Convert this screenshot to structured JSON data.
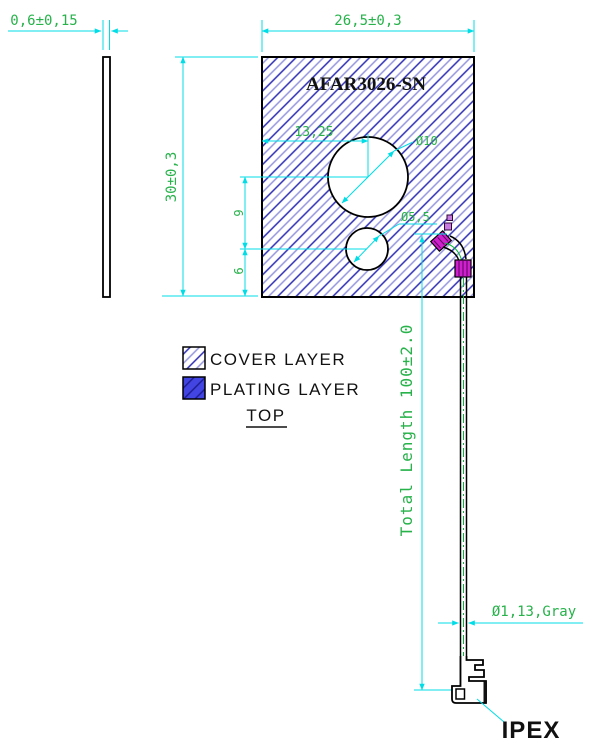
{
  "drawing": {
    "part_number": "AFAR3026-SN",
    "view_label": "TOP",
    "connector_label": "IPEX"
  },
  "dimensions": {
    "thickness": "0,6±0,15",
    "board_width": "26,5±0,3",
    "board_height": "30±0,3",
    "hole_offset_x": "13,25",
    "large_hole_diameter": "Ø10",
    "small_hole_diameter": "Ø5,5",
    "hole_spacing": "9",
    "bottom_offset": "6",
    "cable_length": "Total Length 100±2.0",
    "cable_diameter": "Ø1,13,Gray"
  },
  "legend": {
    "cover_label": "COVER LAYER",
    "plating_label": "PLATING LAYER"
  },
  "colors": {
    "dimension_cyan": "#00dde6",
    "annotation_green": "#27b24a",
    "hatch_dark_blue": "#2d2db4",
    "hatch_light_blue": "#9595de",
    "plating_blue": "#4345e2",
    "solder_magenta": "#cf1fcf",
    "centerline_green": "#00bb33",
    "outline_black": "#000000"
  }
}
